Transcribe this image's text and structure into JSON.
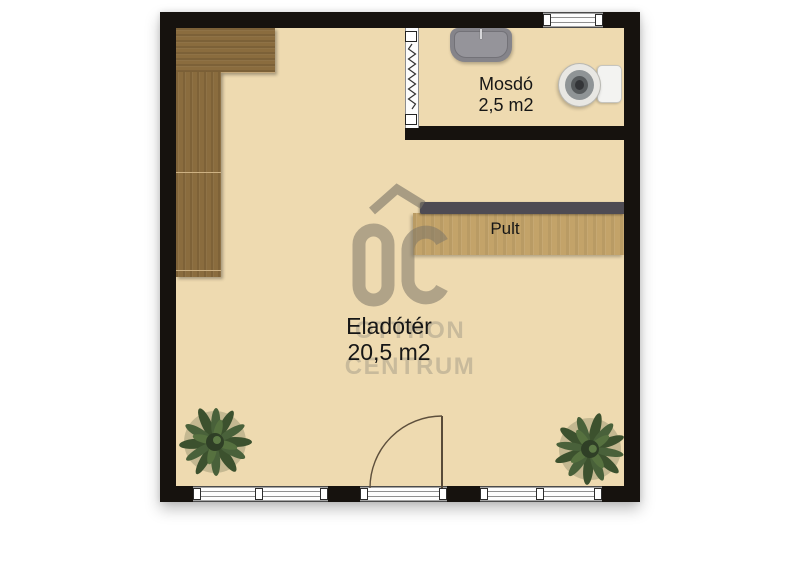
{
  "page": {
    "type": "real-estate-floor-plan",
    "background": "#ffffff"
  },
  "plan": {
    "rooms": [
      {
        "name": "Eladótér",
        "area": "20,5 m2"
      },
      {
        "name": "Mosdó",
        "area": "2,5 m2"
      }
    ],
    "counter_label": "Pult",
    "fixtures": [
      "l-shaped-cabinet",
      "counter-with-dark-top",
      "sink",
      "toilet",
      "folding-door",
      "entrance-door-swing",
      "plant-left",
      "plant-right",
      "storefront-windows",
      "top-window"
    ],
    "colors": {
      "floor": "#eedab0",
      "wall": "#16120e",
      "cabinet_wood": "#8a6c3e",
      "counter_wood": "#c3a369",
      "counter_top": "#4e4b53",
      "plant_green": "#3c512e",
      "door_line": "#584a38",
      "watermark_gray": "#7d7664"
    }
  },
  "watermark": {
    "logo": "OC",
    "name_line1": "OTTHON",
    "name_line2": "CENTRUM"
  }
}
